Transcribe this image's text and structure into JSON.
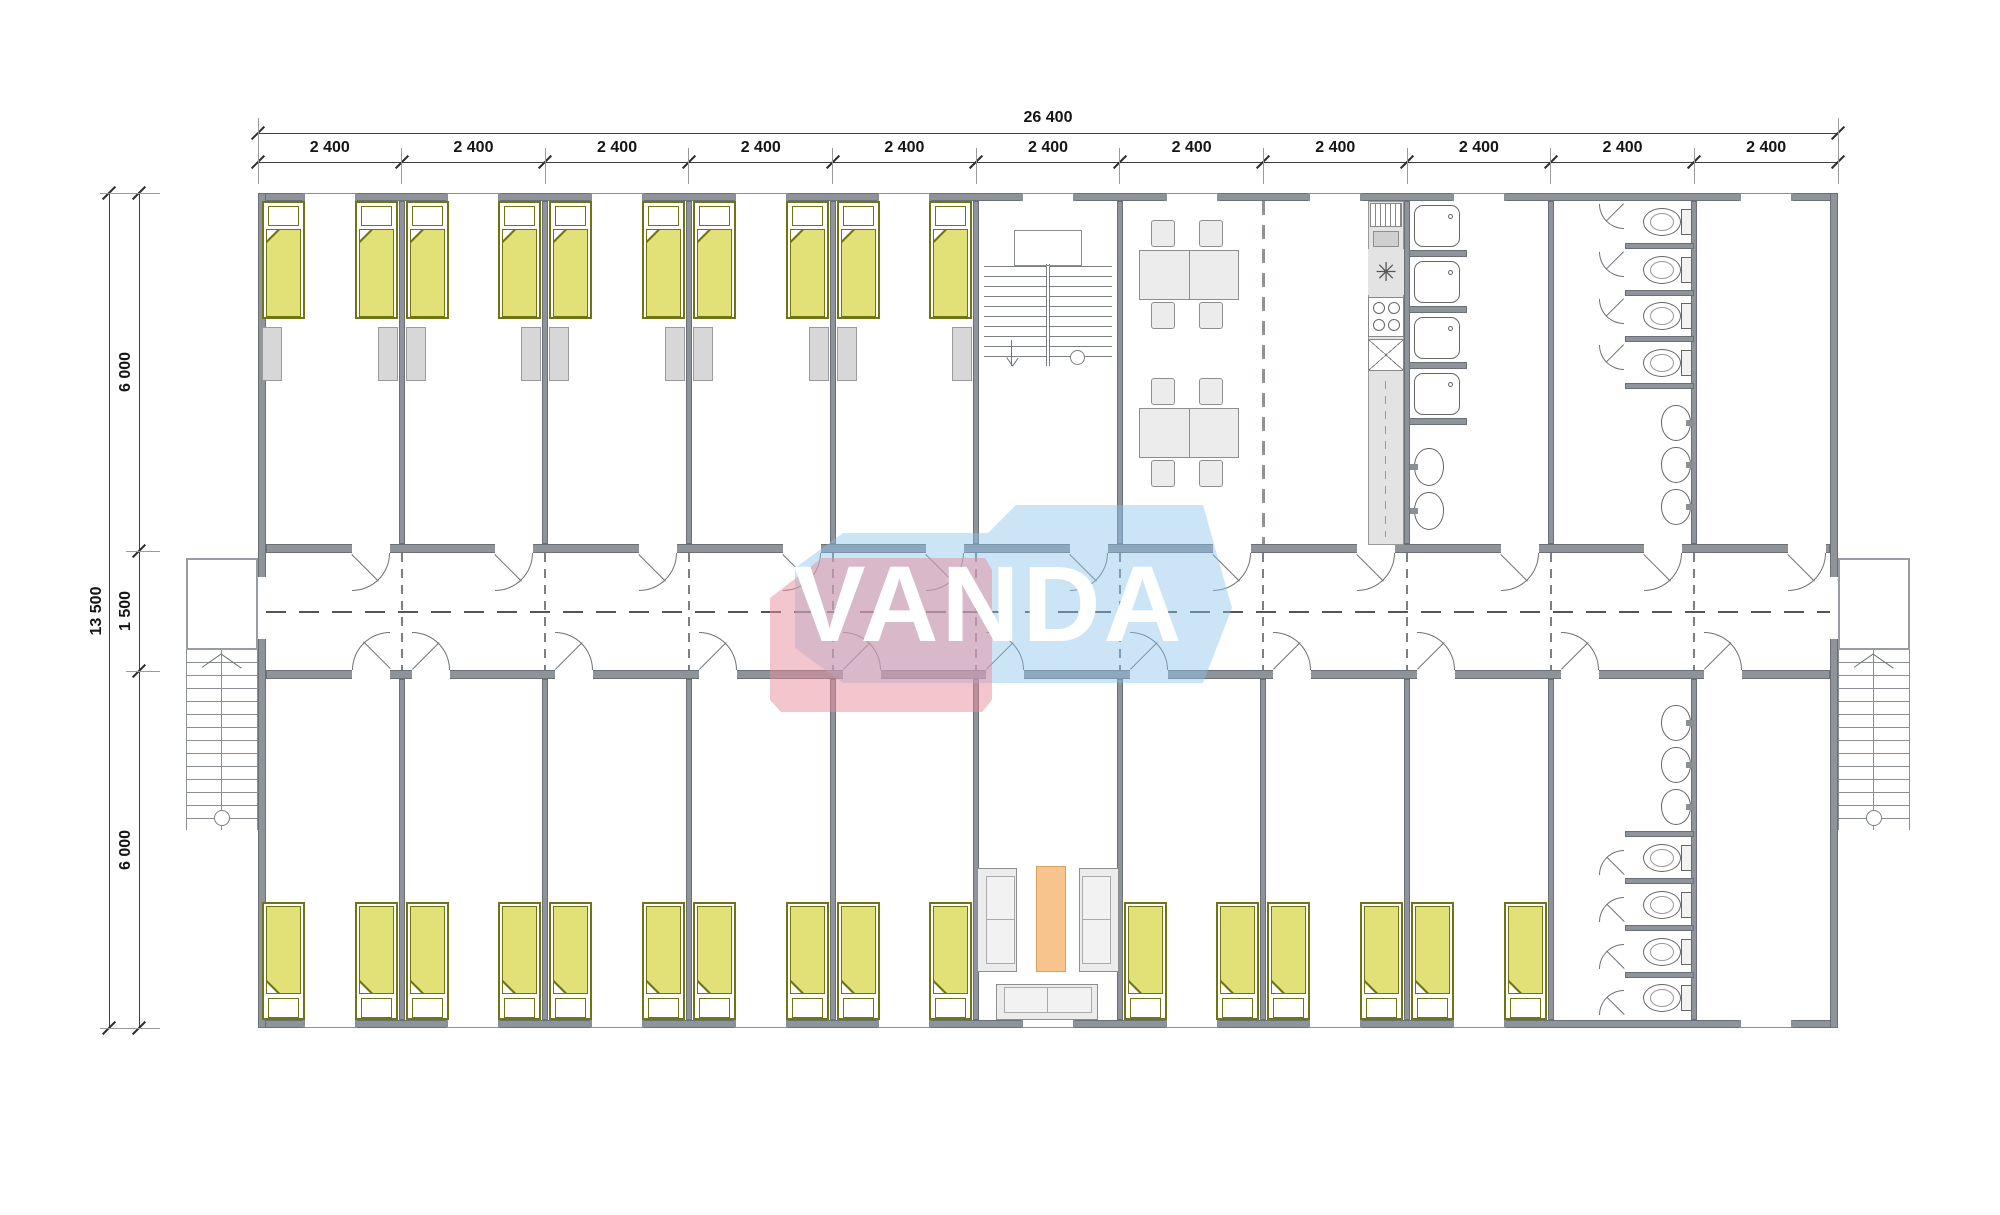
{
  "watermark": {
    "text": "VANDA",
    "pink": "rgba(231,140,155,0.5)",
    "blue": "rgba(140,195,235,0.45)",
    "text_color": "#ffffff"
  },
  "dimensions": {
    "top_total": "26 400",
    "top_segments": [
      "2 400",
      "2 400",
      "2 400",
      "2 400",
      "2 400",
      "2 400",
      "2 400",
      "2 400",
      "2 400",
      "2 400",
      "2 400"
    ],
    "left_total": "13 500",
    "left_segments": [
      "6 000",
      "1 500",
      "6 000"
    ]
  },
  "palette": {
    "wall": "#8f949b",
    "wall_edge": "#6b7076",
    "fixture_line": "#6d7277",
    "dim_text": "#151515",
    "bed_fill": "#e2e178",
    "bed_edge": "#6f7414",
    "pillow": "#ffffff",
    "locker": "#d7d7d7",
    "furniture_fill": "#ececec",
    "furniture_edge": "#8e8e8e",
    "rug": "#f8c48e",
    "rug_edge": "#d9a05e"
  },
  "plan": {
    "bays": 11,
    "rooms_top": [
      "bedroom",
      "bedroom",
      "bedroom",
      "bedroom",
      "bedroom",
      "stairwell",
      "dining",
      "common_kitchen",
      "showers",
      "toilets",
      "room"
    ],
    "rooms_bottom": [
      "bedroom",
      "bedroom",
      "bedroom",
      "bedroom",
      "bedroom",
      "lounge",
      "bedroom",
      "bedroom",
      "bedroom",
      "toilets",
      "room"
    ],
    "counts": {
      "beds": 26,
      "lockers": 10,
      "shower_stalls": 4,
      "toilet_stalls": 8,
      "wash_basins": 8,
      "dining_tables": 2,
      "dining_chairs": 8,
      "sofas": 3,
      "rugs": 1,
      "staircases": 3
    }
  }
}
